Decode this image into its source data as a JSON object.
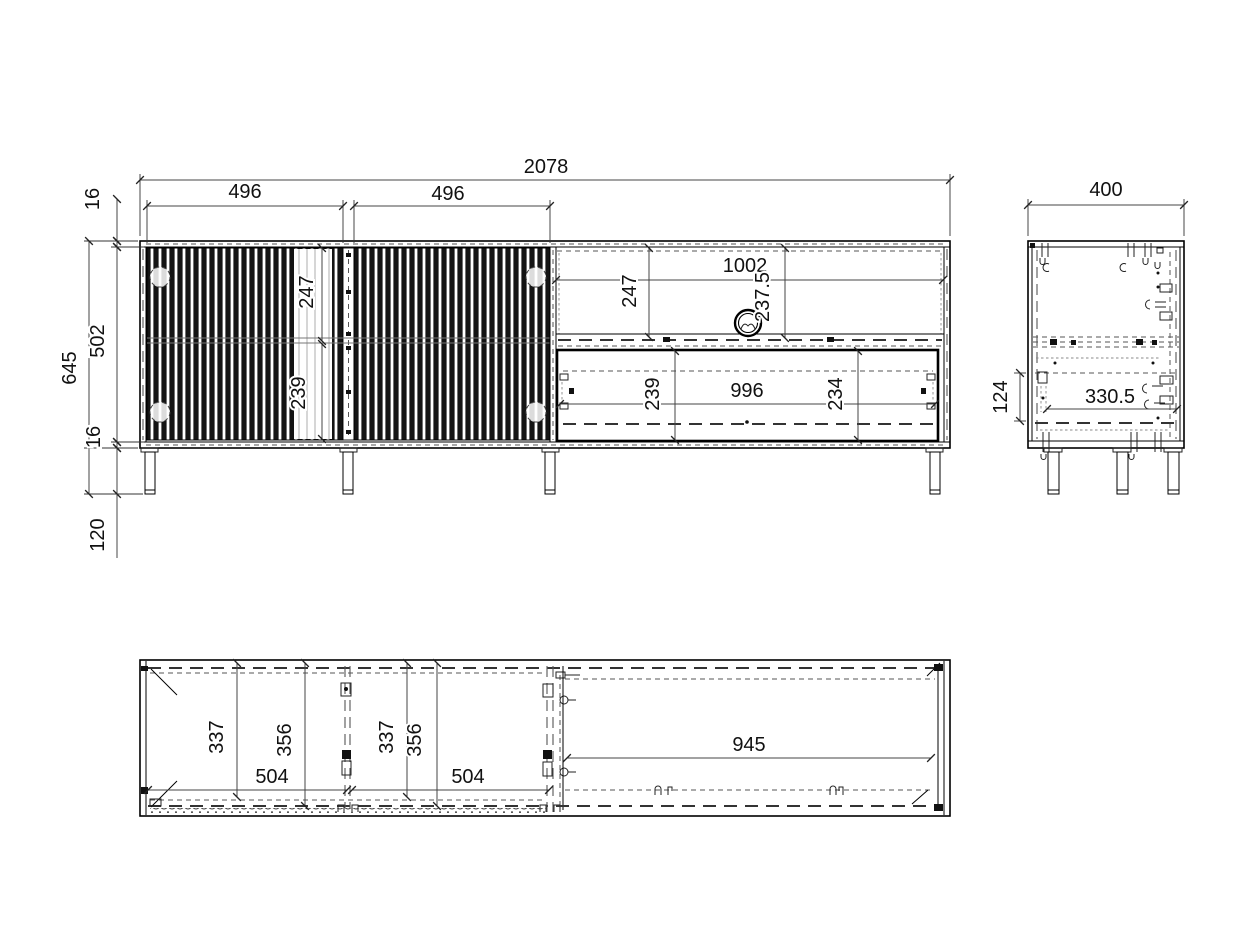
{
  "front_view": {
    "total_width": "2078",
    "left_door_width": "496",
    "right_door_width": "496",
    "top_panel_thickness": "16",
    "carcass_inner_height": "502",
    "total_height": "645",
    "bottom_panel_thickness": "16",
    "leg_height": "120",
    "left_door_upper": "247",
    "left_door_lower": "239",
    "niche_width": "1002",
    "niche_height": "247",
    "cable_hole_offset": "237.5",
    "drawer_left_height": "239",
    "drawer_inner_width": "996",
    "drawer_right_height": "234"
  },
  "side_view": {
    "depth": "400",
    "inner_depth": "330.5",
    "drawer_offset": "124"
  },
  "top_view": {
    "left_door_dim_a": "337",
    "left_door_dim_b": "356",
    "left_door_width": "504",
    "right_door_dim_a": "337",
    "right_door_dim_b": "356",
    "right_door_width": "504",
    "niche_width": "945"
  }
}
